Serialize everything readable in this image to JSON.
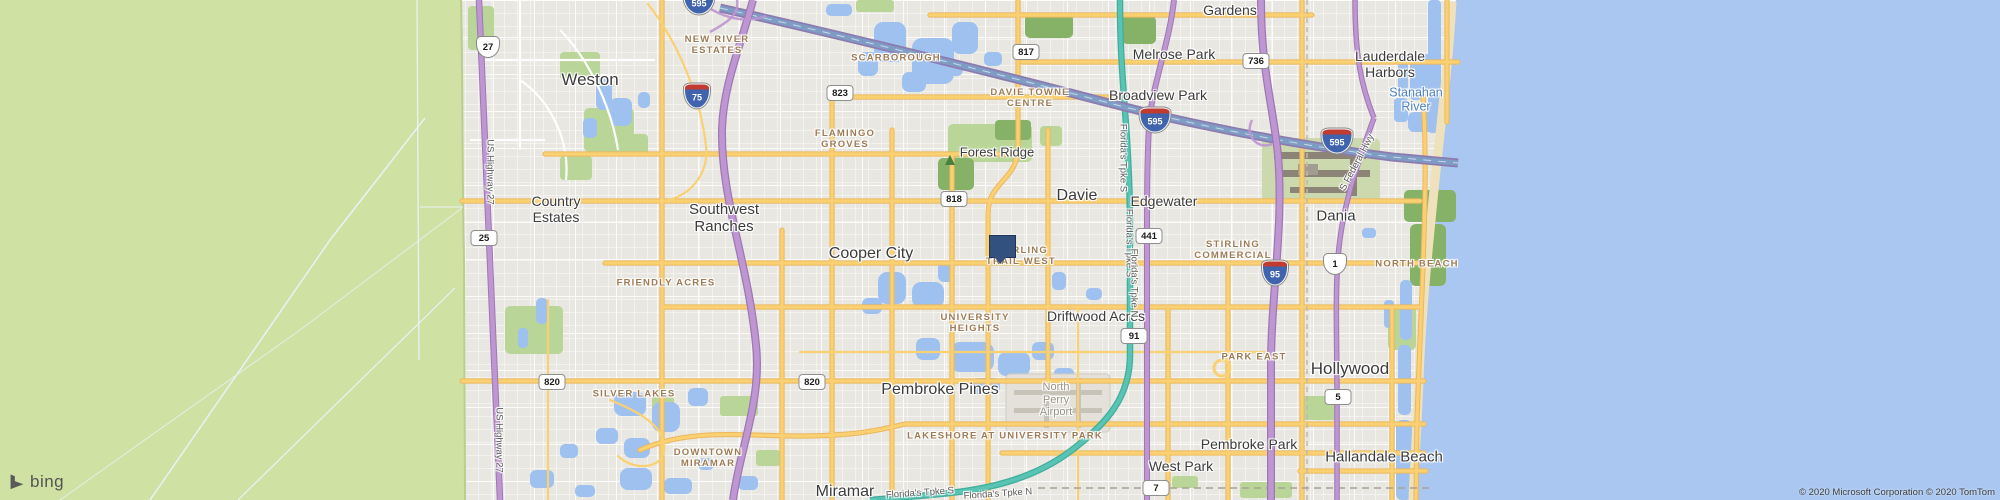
{
  "map": {
    "logo_text": "bing",
    "attribution": "© 2020 Microsoft Corporation © 2020 TomTom",
    "colors": {
      "land": "#e9e7e1",
      "everglades": "#cfe2a3",
      "ocean": "#a9c7f1",
      "lake": "#9fc1ef",
      "park": "#b9d698",
      "forest": "#86b267",
      "road_yellow": "#fad172",
      "highway_purple": "#be96d2",
      "turnpike_teal": "#59c3b4",
      "expressway_blue": "#7e9cc4",
      "marker_blue": "#33517e",
      "neighborhood_text": "#9d7b55",
      "city_text": "#3c3c3c",
      "water_text": "#4d80c4"
    },
    "marker": {
      "x": 1001,
      "y": 235,
      "note": "blue square pushpin near Stirling Trail West"
    },
    "labels": {
      "cities": [
        {
          "t": "Weston",
          "x": 590,
          "y": 80,
          "s": 17
        },
        {
          "t": "Country\nEstates",
          "x": 556,
          "y": 209,
          "s": 14
        },
        {
          "t": "Southwest\nRanches",
          "x": 724,
          "y": 218,
          "s": 15
        },
        {
          "t": "Cooper City",
          "x": 871,
          "y": 254,
          "s": 16
        },
        {
          "t": "Davie",
          "x": 1077,
          "y": 196,
          "s": 16
        },
        {
          "t": "Edgewater",
          "x": 1164,
          "y": 201,
          "s": 14
        },
        {
          "t": "Forest Ridge",
          "x": 997,
          "y": 153,
          "s": 13
        },
        {
          "t": "Melrose Park",
          "x": 1174,
          "y": 54,
          "s": 14
        },
        {
          "t": "Broadview Park",
          "x": 1158,
          "y": 95,
          "s": 14
        },
        {
          "t": "Gardens",
          "x": 1230,
          "y": 10,
          "s": 14
        },
        {
          "t": "Lauderdale\nHarbors",
          "x": 1390,
          "y": 64,
          "s": 14
        },
        {
          "t": "Dania",
          "x": 1336,
          "y": 216,
          "s": 15
        },
        {
          "t": "Hollywood",
          "x": 1350,
          "y": 369,
          "s": 17
        },
        {
          "t": "Pembroke Pines",
          "x": 940,
          "y": 390,
          "s": 16
        },
        {
          "t": "Miramar",
          "x": 845,
          "y": 492,
          "s": 16
        },
        {
          "t": "West Park",
          "x": 1181,
          "y": 466,
          "s": 14
        },
        {
          "t": "Pembroke Park",
          "x": 1249,
          "y": 444,
          "s": 14
        },
        {
          "t": "Hallandale Beach",
          "x": 1384,
          "y": 457,
          "s": 15
        },
        {
          "t": "Driftwood Acres",
          "x": 1096,
          "y": 316,
          "s": 14
        }
      ],
      "neighborhoods": [
        {
          "t": "NEW RIVER\nESTATES",
          "x": 717,
          "y": 46
        },
        {
          "t": "SCARBOROUGH",
          "x": 896,
          "y": 59
        },
        {
          "t": "DAVIE TOWNE\nCENTRE",
          "x": 1030,
          "y": 99
        },
        {
          "t": "FLAMINGO\nGROVES",
          "x": 845,
          "y": 140
        },
        {
          "t": "FRIENDLY ACRES",
          "x": 666,
          "y": 284
        },
        {
          "t": "SILVER LAKES",
          "x": 634,
          "y": 395
        },
        {
          "t": "UNIVERSITY\nHEIGHTS",
          "x": 975,
          "y": 324
        },
        {
          "t": "STIRLING\nTRAIL WEST",
          "x": 1021,
          "y": 257
        },
        {
          "t": "STIRLING\nCOMMERCIAL",
          "x": 1233,
          "y": 251
        },
        {
          "t": "NORTH BEACH",
          "x": 1417,
          "y": 265
        },
        {
          "t": "PARK EAST",
          "x": 1254,
          "y": 358
        },
        {
          "t": "DOWNTOWN\nMIRAMAR",
          "x": 708,
          "y": 459
        },
        {
          "t": "LAKESHORE AT UNIVERSITY PARK",
          "x": 1005,
          "y": 437
        }
      ],
      "water": [
        {
          "t": "Stanahan\nRiver",
          "x": 1416,
          "y": 100,
          "s": 12.5
        }
      ],
      "areas": [
        {
          "t": "North\nPerry\nAirport",
          "x": 1056,
          "y": 400,
          "s": 11
        }
      ],
      "roads": [
        {
          "t": "US Highway 27",
          "x": 489,
          "y": 172,
          "r": 90
        },
        {
          "t": "US Highway 27",
          "x": 498,
          "y": 440,
          "r": 90
        },
        {
          "t": "Florida's Tpke S",
          "x": 1122,
          "y": 158,
          "r": 90
        },
        {
          "t": "Florida's Tpke S",
          "x": 1128,
          "y": 243,
          "r": 90
        },
        {
          "t": "Florida's Tpke N",
          "x": 1133,
          "y": 283,
          "r": 90
        },
        {
          "t": "Florida's Tpke S",
          "x": 920,
          "y": 494,
          "r": -4
        },
        {
          "t": "Florida's Tpke N",
          "x": 998,
          "y": 495,
          "r": -4
        },
        {
          "t": "S Federal Hwy",
          "x": 1358,
          "y": 163,
          "r": -62
        }
      ]
    },
    "shields": [
      {
        "style": "us",
        "n": "27",
        "x": 488,
        "y": 47
      },
      {
        "style": "state",
        "n": "25",
        "x": 484,
        "y": 238
      },
      {
        "style": "interstate",
        "n": "595",
        "x": 699,
        "y": 2
      },
      {
        "style": "interstate",
        "n": "75",
        "x": 697,
        "y": 96
      },
      {
        "style": "state",
        "n": "823",
        "x": 840,
        "y": 93
      },
      {
        "style": "state",
        "n": "817",
        "x": 1026,
        "y": 52
      },
      {
        "style": "state",
        "n": "736",
        "x": 1256,
        "y": 61
      },
      {
        "style": "interstate",
        "n": "595",
        "x": 1155,
        "y": 120
      },
      {
        "style": "interstate",
        "n": "595",
        "x": 1337,
        "y": 141
      },
      {
        "style": "state",
        "n": "818",
        "x": 954,
        "y": 199
      },
      {
        "style": "state",
        "n": "441",
        "x": 1149,
        "y": 236
      },
      {
        "style": "interstate",
        "n": "95",
        "x": 1275,
        "y": 273
      },
      {
        "style": "us",
        "n": "1",
        "x": 1335,
        "y": 264
      },
      {
        "style": "state",
        "n": "91",
        "x": 1134,
        "y": 336
      },
      {
        "style": "state",
        "n": "820",
        "x": 552,
        "y": 382
      },
      {
        "style": "state",
        "n": "820",
        "x": 812,
        "y": 382
      },
      {
        "style": "state",
        "n": "5",
        "x": 1338,
        "y": 397
      },
      {
        "style": "state",
        "n": "7",
        "x": 1156,
        "y": 488
      }
    ],
    "park_icons": [
      {
        "x": 950,
        "y": 160
      }
    ]
  }
}
